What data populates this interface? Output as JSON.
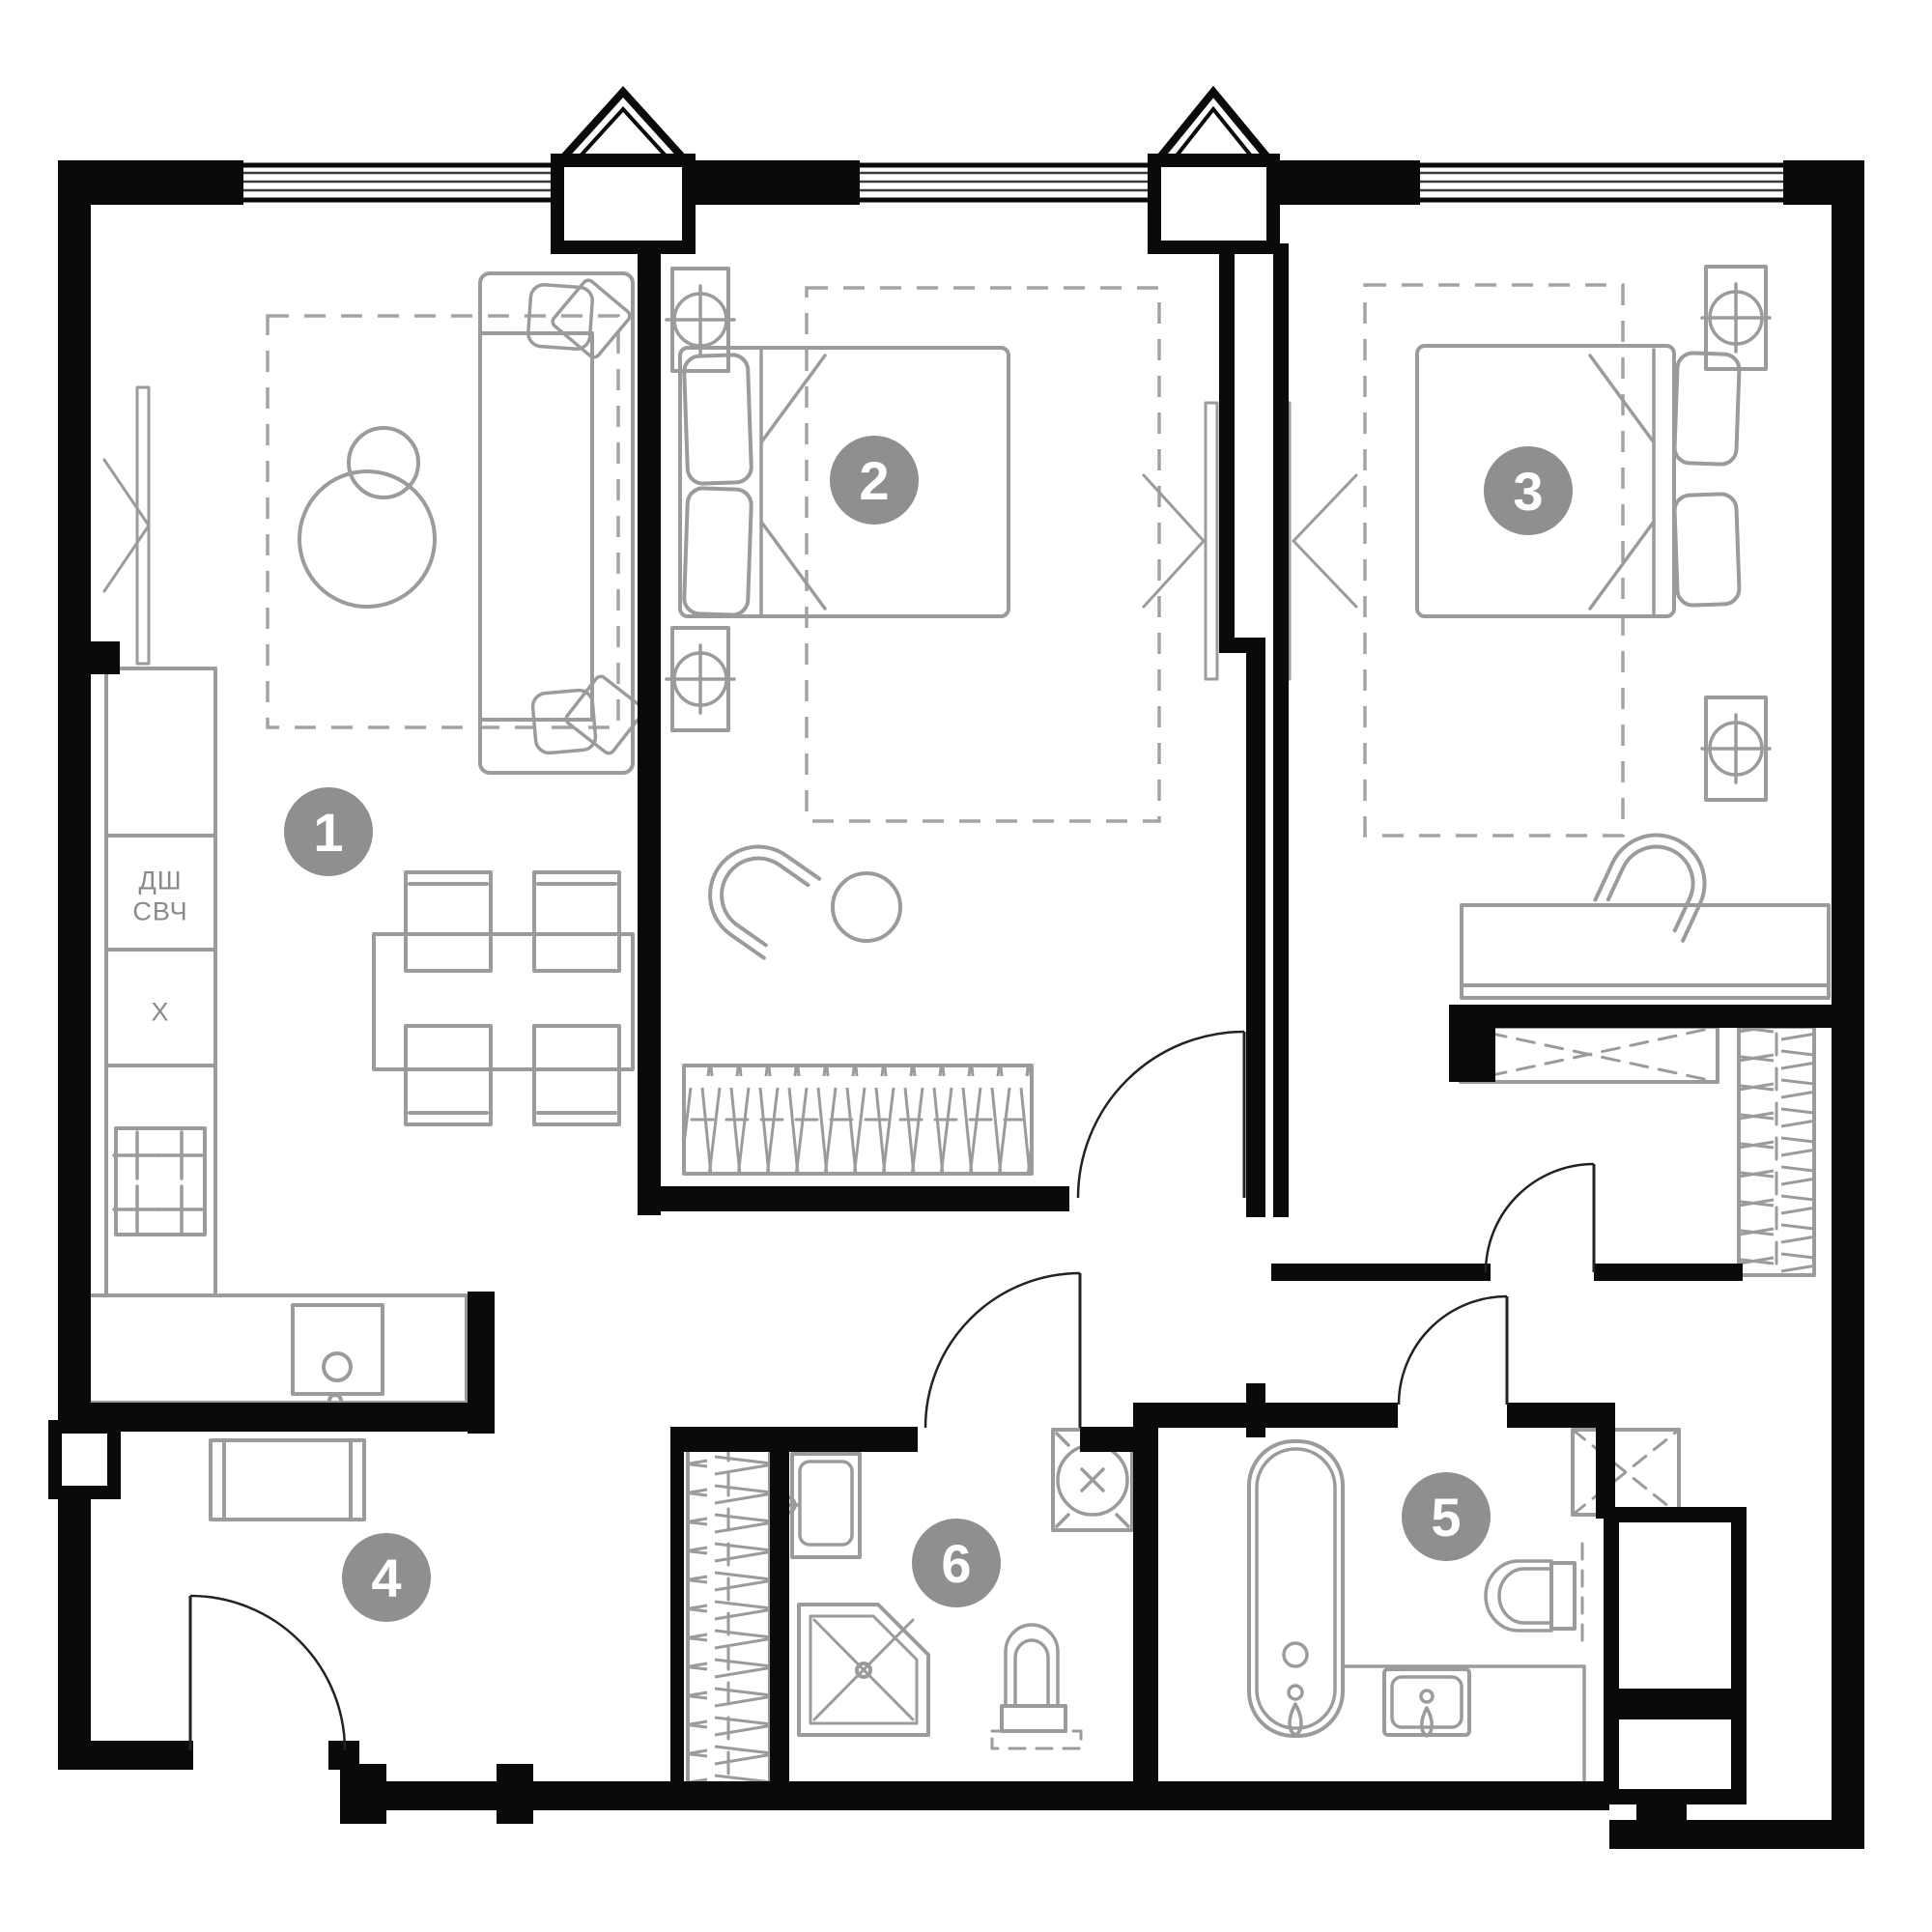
{
  "plan": {
    "title": "apartment-floor-plan",
    "colors": {
      "wall": "#0a0a0a",
      "furniture": "#9b9b9b",
      "badge_background": "#8f8f8f",
      "badge_text": "#ffffff",
      "label_text": "#8a8a8a",
      "background": "#ffffff"
    },
    "rooms": [
      {
        "number": "1",
        "name": "living-room-kitchen"
      },
      {
        "number": "2",
        "name": "bedroom-1"
      },
      {
        "number": "3",
        "name": "bedroom-2"
      },
      {
        "number": "4",
        "name": "hallway"
      },
      {
        "number": "5",
        "name": "bathroom-1"
      },
      {
        "number": "6",
        "name": "bathroom-2"
      }
    ],
    "kitchen": {
      "labels": [
        "ДШ",
        "СВЧ",
        "X"
      ]
    },
    "icons": {
      "stove": "stove-burners-icon",
      "sink": "sink-icon",
      "bathtub": "bathtub-icon",
      "shower": "shower-icon",
      "toilet": "toilet-icon",
      "washing_machine": "washing-machine-icon",
      "radiator": "radiator-vent-icon",
      "tv": "tv-arrow-icon",
      "wardrobe": "wardrobe-hangers-icon",
      "bed": "bed-icon",
      "sofa": "sofa-icon",
      "door": "door-swing-icon",
      "window": "window-icon",
      "bay": "bay-window-icon"
    }
  }
}
